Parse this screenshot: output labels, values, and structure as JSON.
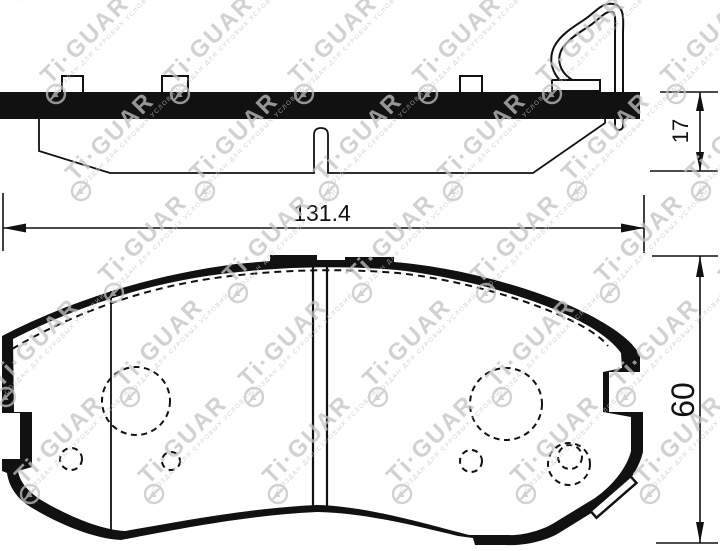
{
  "drawing": {
    "title_parts": {
      "side_view": "brake-pad-side-profile",
      "front_view": "brake-pad-front-face",
      "logo": "circle-slash-triangle-icon"
    },
    "dims": {
      "width": "131.4",
      "thickness": "17",
      "height": "60"
    },
    "watermark": {
      "text": "Ti·GUAR",
      "tagline": "СОЗДАН ДЛЯ СУРОВЫХ УСЛОВИЙ"
    },
    "colors": {
      "ink": "#111111",
      "watermark": "#c3c3c3",
      "background": "#ffffff"
    }
  }
}
